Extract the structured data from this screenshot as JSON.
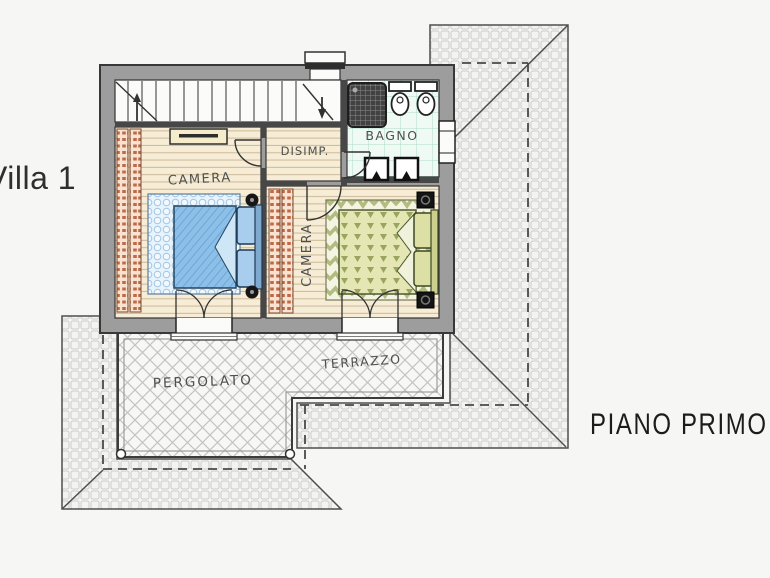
{
  "page": {
    "background_color": "#f6f6f4",
    "villa_title": "Villa 1",
    "floor_title": "PIANO PRIMO"
  },
  "rooms": {
    "camera1_label": "CAMERA",
    "camera2_label": "CAMERA",
    "disimpegno_label": "DISIMP.",
    "bagno_label": "BAGNO",
    "pergolato_label": "PERGOLATO",
    "terrazzo_label": "TERRAZZO"
  },
  "colors": {
    "wall_fill": "#9d9d9d",
    "wall_outline": "#383838",
    "wood_floor": "#f7edd6",
    "bath_tile": "#f0faf5",
    "bed_blue": "#8cc0e8",
    "rug_blue": "#e8f3fb",
    "bed_green": "#e4e7b4",
    "rug_green": "#f4f4e2",
    "radiator_red": "#bc6a49",
    "roof_line": "#cccccb",
    "label_text": "#4f4f4f",
    "title_text": "#2f2f2f"
  }
}
